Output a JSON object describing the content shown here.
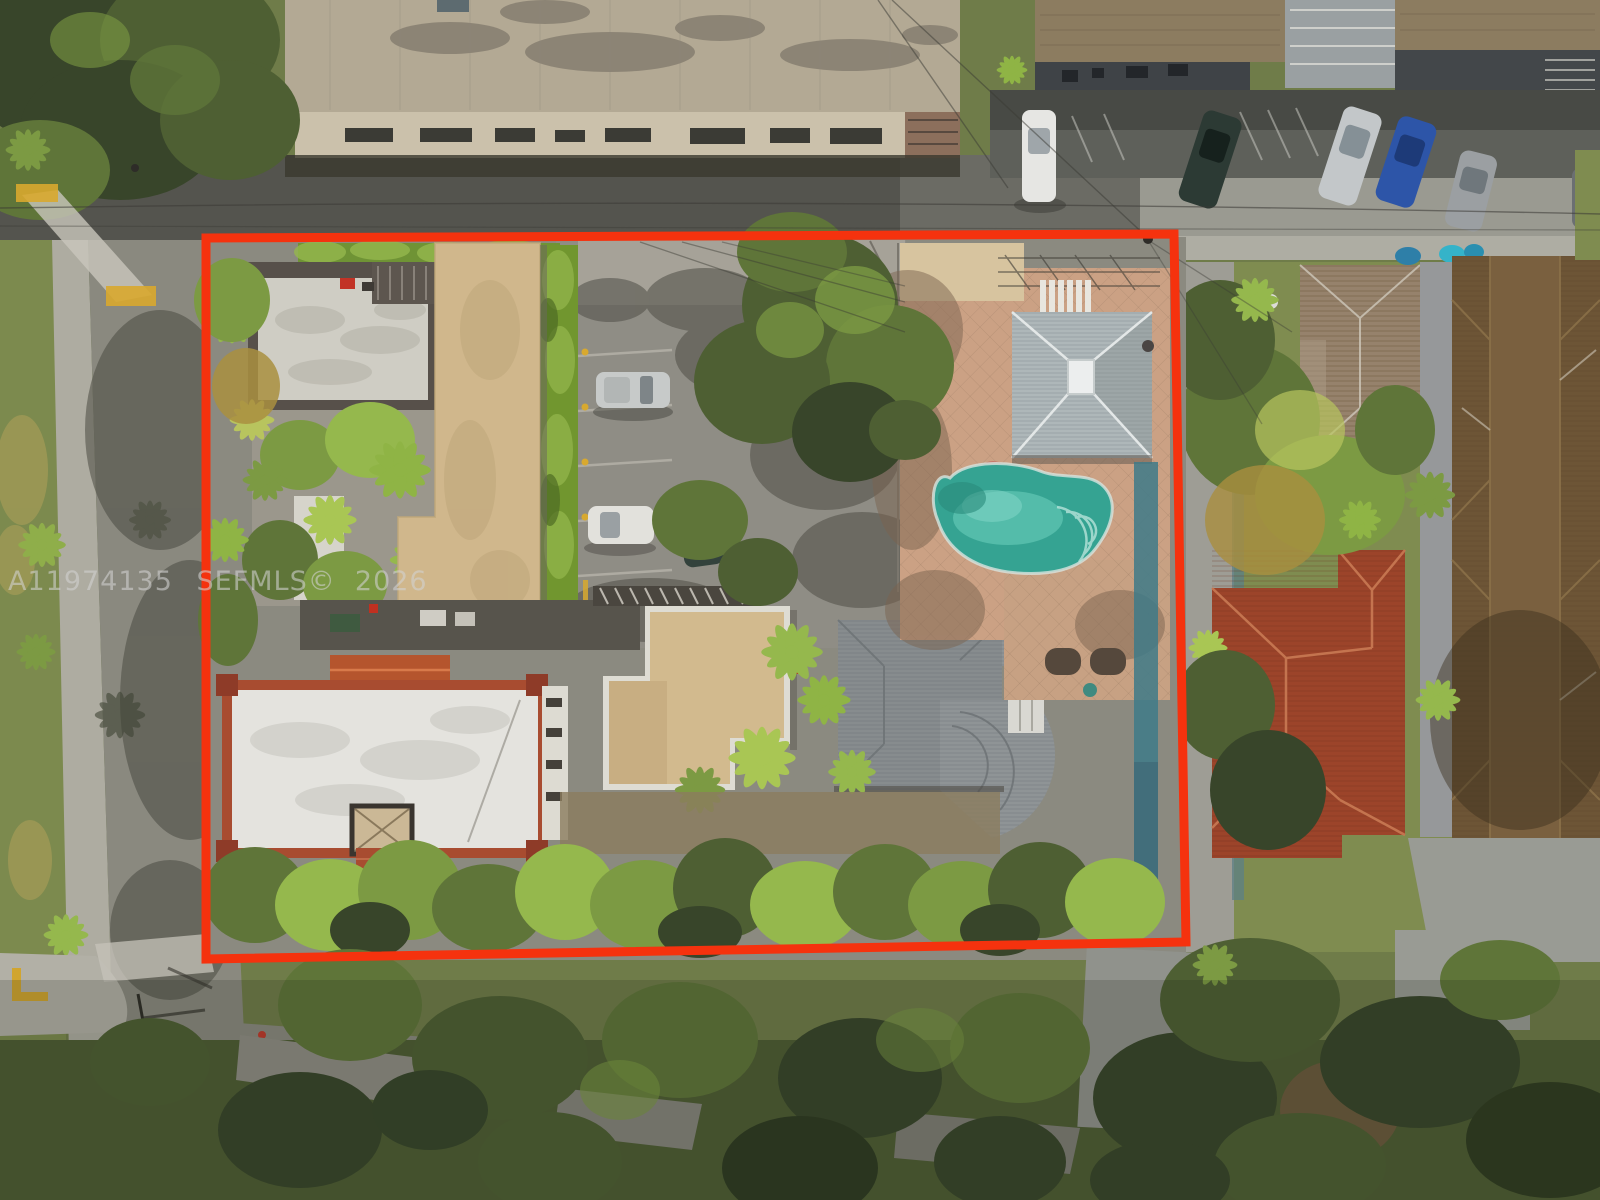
{
  "image": {
    "kind": "aerial-drone-photograph",
    "subject": "multifamily property lot outlined in red for an MLS real-estate listing"
  },
  "watermark": {
    "listing_id": "A11974135",
    "mls": "SEFMLS©",
    "year": "2026",
    "text_color": "#d2d2d2"
  },
  "annotation": {
    "type": "property-boundary-outline",
    "color": "#f5320e",
    "stroke_px": 9
  },
  "scene": {
    "key_colors": {
      "pool_water": "#35a392",
      "pool_deck_pavers": "#cba184",
      "tan_apartment_roof": "#d0b78c",
      "white_building_roof": "#e4e3de",
      "white_building_tile_trim": "#a84c30",
      "gray_house_roof": "#878c8e",
      "cabana_roof": "#aeb7b9",
      "red_tile_house_roof": "#9c442a",
      "brown_apartment_roof": "#6d5536",
      "street_asphalt": "#8a897f"
    },
    "features_inside_boundary": [
      "tan-roof apartment building",
      "white roof deck with red chair",
      "palm courtyard",
      "parking lot with three cars",
      "privacy hedge",
      "large shade tree",
      "kidney-shaped swimming pool",
      "pink spa",
      "paver pool deck",
      "gray hip-roof cabana with skylight",
      "white flat-roof building with red tile trim",
      "orange gable roof",
      "tan middle building",
      "gray shingle house with rounded bay",
      "white shed",
      "dense tree line at rear"
    ],
    "features_outside_boundary": [
      "industrial building with stained roof",
      "street with power lines",
      "townhouses with angled street parking",
      "five parked cars",
      "spanish-tile house",
      "red clay-tile house",
      "long brown apartment building",
      "tree-lined side street",
      "intersection with yellow curb markings",
      "crosswalks",
      "dense canopy over rear street"
    ],
    "parked_cars_inside": [
      "silver suv",
      "white sedan",
      "dark green sedan"
    ],
    "parked_cars_top_right": [
      "white",
      "dark-green",
      "silver",
      "blue",
      "gray"
    ]
  }
}
